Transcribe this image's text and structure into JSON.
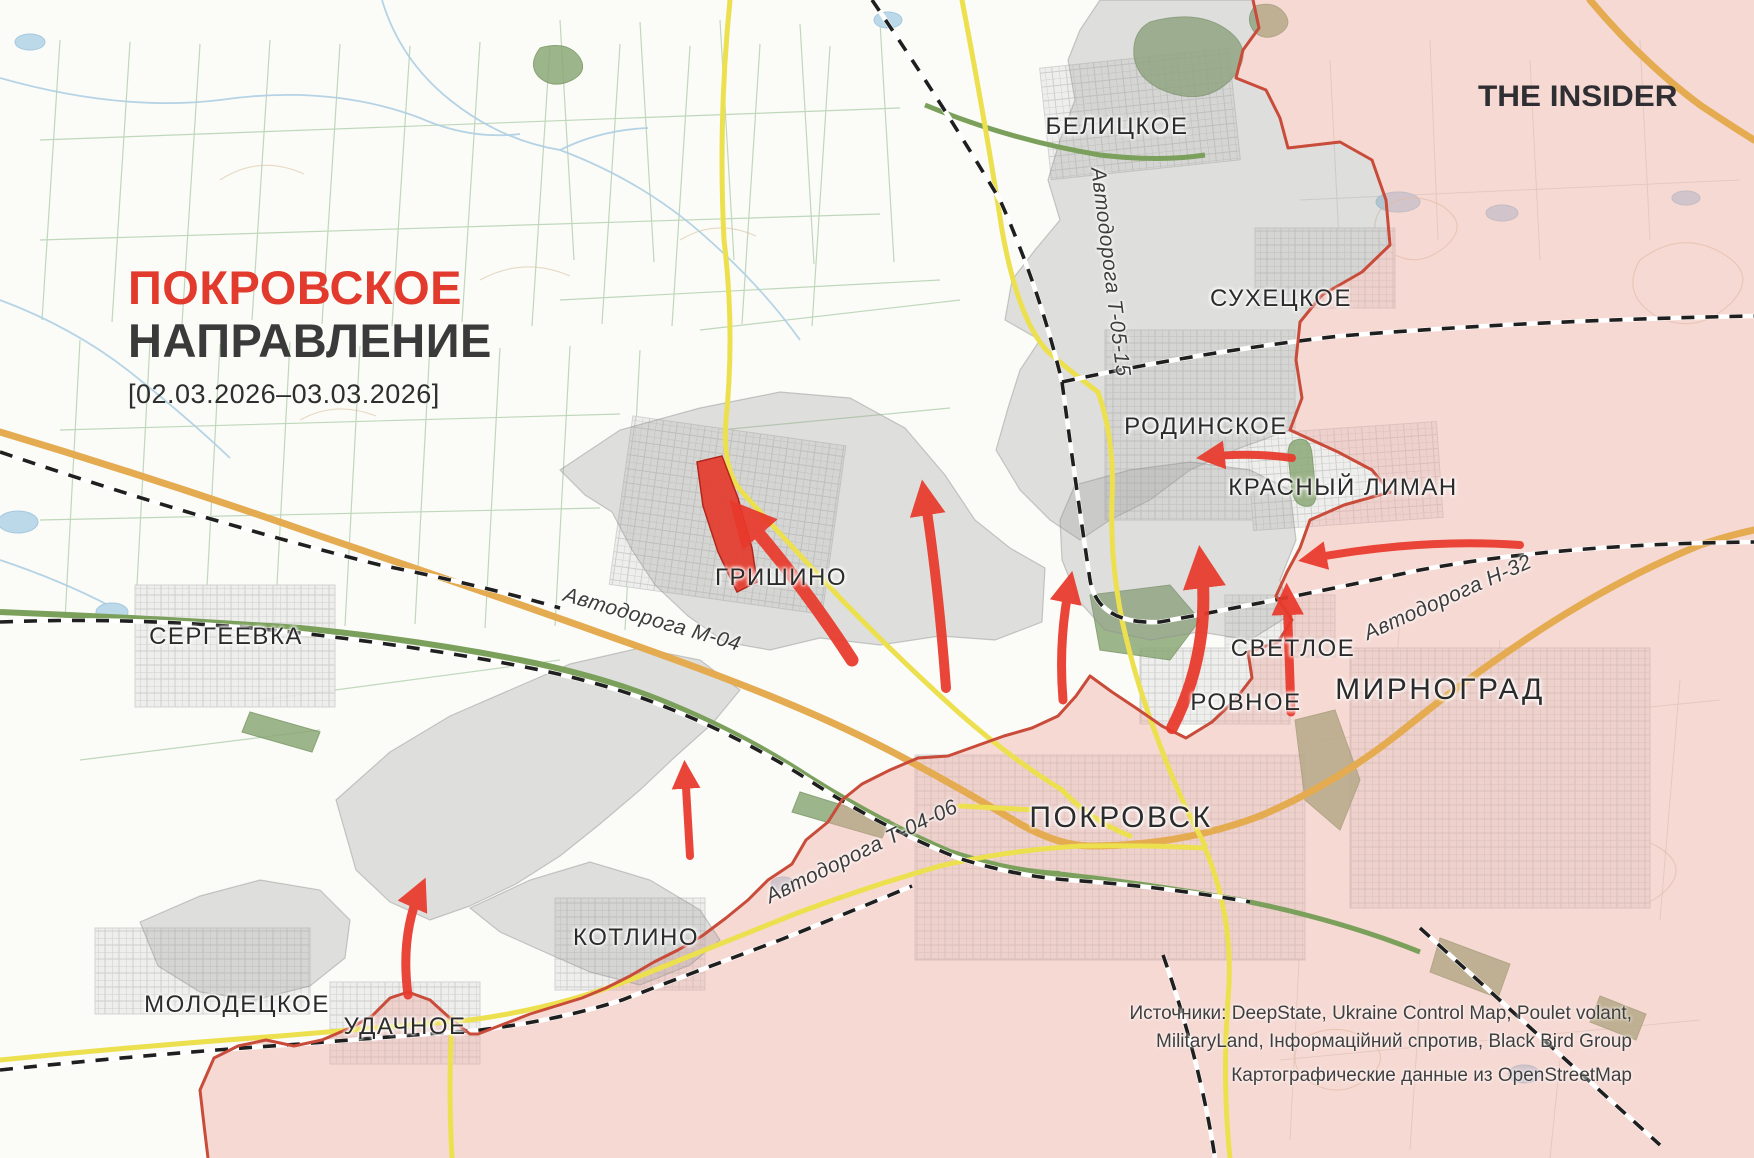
{
  "header": {
    "title_line1": "ПОКРОВСКОЕ",
    "title_line2": "НАПРАВЛЕНИЕ",
    "date_range": "[02.03.2026–03.03.2026]",
    "brand": "THE INSIDER"
  },
  "map": {
    "settlements": {
      "belitskoye": "БЕЛИЦКОЕ",
      "sukhetskoye": "СУХЕЦКОЕ",
      "rodinskoye": "РОДИНСКОЕ",
      "krasny_liman": "КРАСНЫЙ ЛИМАН",
      "grishino": "ГРИШИНО",
      "sergeyevka": "СЕРГЕЕВКА",
      "svetloye": "СВЕТЛОЕ",
      "rovnoye": "РОВНОЕ",
      "mirnograd": "МИРНОГРАД",
      "pokrovsk": "ПОКРОВСК",
      "kotlino": "КОТЛИНО",
      "molodetskoye": "МОЛОДЕЦКОЕ",
      "udachnoye": "УДАЧНОЕ"
    },
    "roads": {
      "t0515": "Автодорога Т-05-15",
      "m04": "Автодорога М-04",
      "h32": "Автодорога Н-32",
      "t0406": "Автодорога Т-04-06"
    },
    "legend_colors": {
      "occupied_fill": "#f6d9d4",
      "contested_fill": "#d9d9d9",
      "recent_advance_fill": "#e8392b",
      "frontline": "#c94b3a",
      "attack_arrow": "#e8392b"
    }
  },
  "footer": {
    "sources_line1": "Источники: DeepState, Ukraine Control Map, Poulet volant,",
    "sources_line2": "MilitaryLand, Інформаційний спротив, Black Bird Group",
    "sources_line3": "Картографические данные из OpenStreetMap"
  }
}
